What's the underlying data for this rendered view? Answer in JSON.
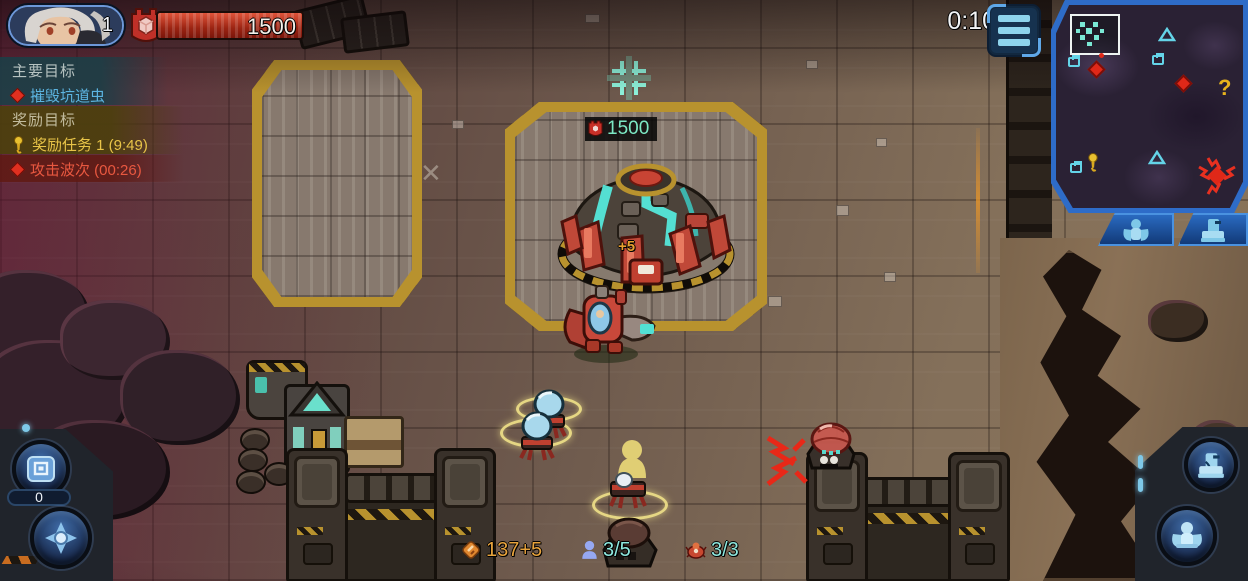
{
  "player": {
    "level": "1",
    "hp": "1500"
  },
  "objectives": {
    "main_header": "主要目标",
    "main_task": "摧毁坑道虫",
    "bonus_header": "奖励目标",
    "bonus_task": "奖励任务 1 (9:49)",
    "wave_task": "攻击波次 (00:26)"
  },
  "timer": "0:10",
  "base": {
    "hp": "1500",
    "income_float": "+5"
  },
  "minimap": {
    "question_mark": "?"
  },
  "bottom_left": {
    "crate_count": "0"
  },
  "resources": {
    "minerals": "137+5",
    "population": "3/5",
    "squad": "3/3"
  },
  "colors": {
    "accent_blue": "#2e6cc8",
    "hp_red": "#9c2412",
    "objective_blue": "#5cb4e0",
    "objective_yellow": "#e8c448",
    "objective_red": "#e85840",
    "resource_orange": "#e8a33c",
    "resource_cyan": "#8ee8de",
    "base_hp_teal": "#7ce8c4"
  }
}
